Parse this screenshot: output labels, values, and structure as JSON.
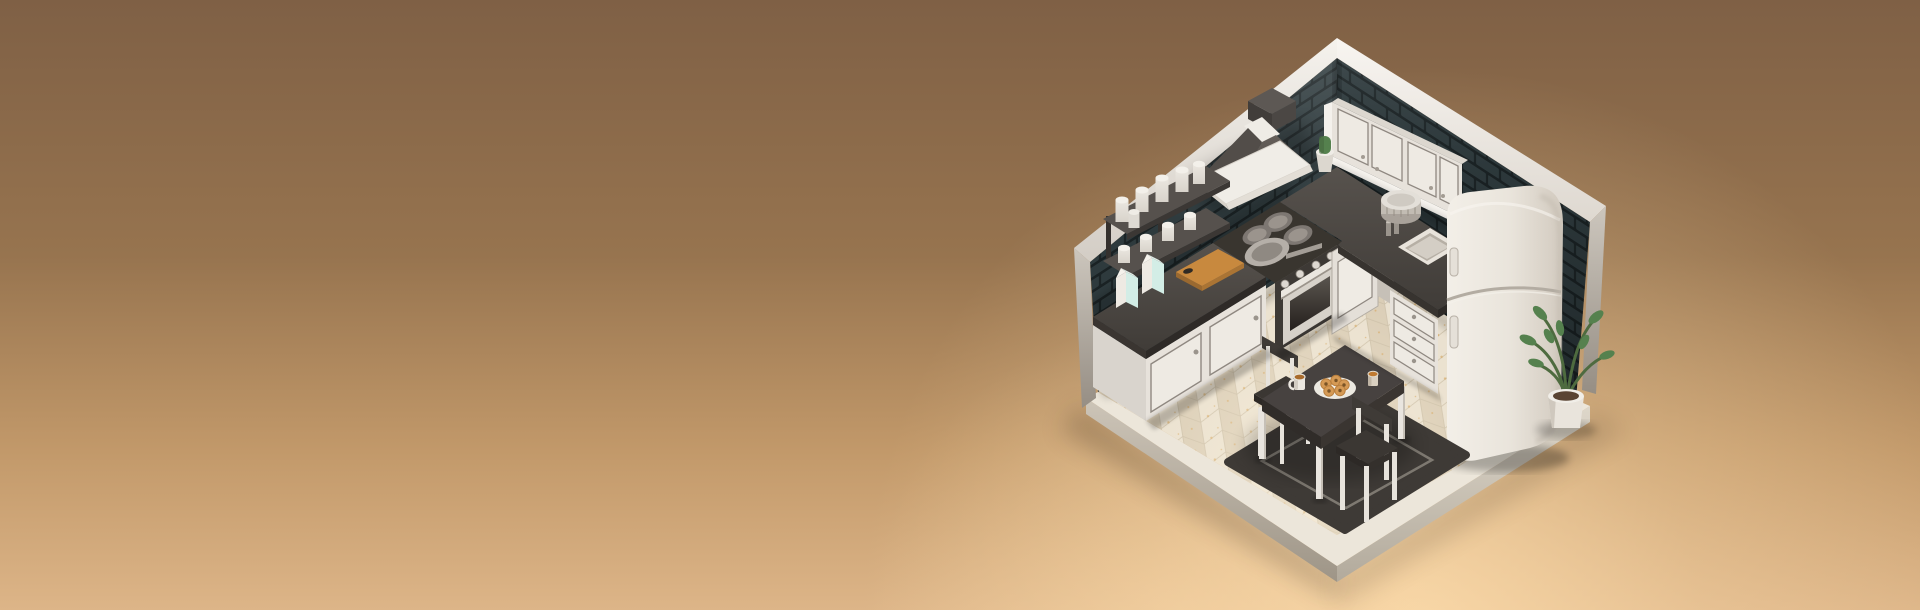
{
  "scene": {
    "type": "3d-isometric-render",
    "subject": "Miniature isometric kitchen room diorama on a warm tan backdrop",
    "aria_label": "3D isometric render of a tiny kitchen room with dark subway-tile walls, white cabinets, a range hood over a stove, sink, retro refrigerator, plants, and a small dining table with donuts and coffee on a dark rug over a herringbone wood floor",
    "background": {
      "bg_top": "#7f6045",
      "bg_mid1": "#97744f",
      "bg_mid2": "#c2996a",
      "bg_bottom": "#ddb588",
      "glow": "#ffdfae"
    },
    "room": {
      "wall_tile": "#2e3a3d",
      "wall_grout": "#1a2224",
      "trim": "#f2efe9",
      "floor_base": "#e5dbc8",
      "floor_plank_light": "#e9e0cf",
      "floor_plank_dark": "#d9ccb5",
      "fleck": "#d2a258",
      "counter": "#4b4642",
      "cabinet": "#e7e2db",
      "appliance": "#45403c",
      "fridge": "#ece7df",
      "board": "#c8893e",
      "plant": "#55814e",
      "rug": "#3e3a36"
    },
    "objects": [
      "subway-tile-walls",
      "white-top-trim",
      "range-hood",
      "wall-shelves-with-cups",
      "milk-cartons",
      "cutting-board",
      "stove-with-oven",
      "frying-pan",
      "upper-cabinets",
      "cactus-pot",
      "plate-stack",
      "sink",
      "drawer-unit",
      "retro-refrigerator",
      "potted-plant",
      "dark-rug",
      "dining-table",
      "donut-plate",
      "coffee-cups",
      "two-chairs",
      "herringbone-floor",
      "display-platform"
    ]
  }
}
